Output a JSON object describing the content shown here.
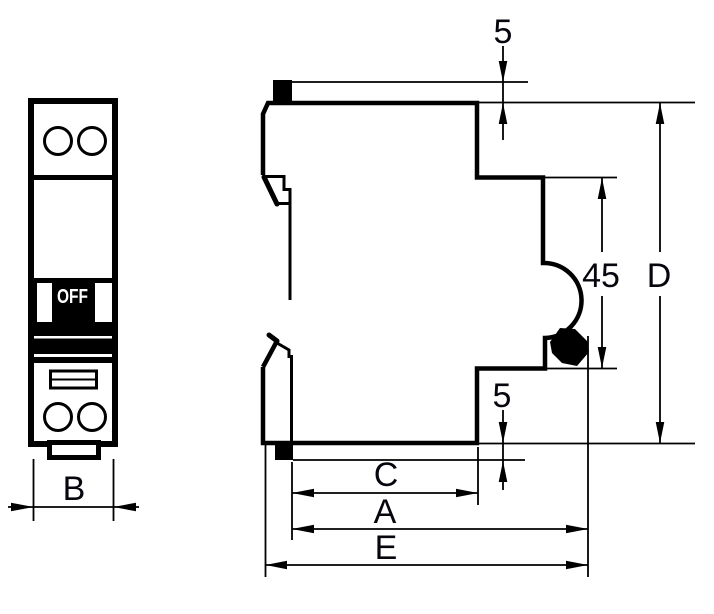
{
  "figure": {
    "type": "technical-dimension-drawing",
    "subject": "modular circuit breaker outline, front view and side profile with dimension callouts",
    "labels": {
      "top_offset": "5",
      "module_height": "45",
      "height_total": "D",
      "bottom_offset": "5",
      "depth_c": "C",
      "depth_a": "A",
      "depth_e": "E",
      "width_b": "B",
      "switch_state": "OFF"
    },
    "colors": {
      "line": "#000000",
      "label_text": "#06060e",
      "background": "#ffffff",
      "switch_text": "#ffffff"
    }
  }
}
